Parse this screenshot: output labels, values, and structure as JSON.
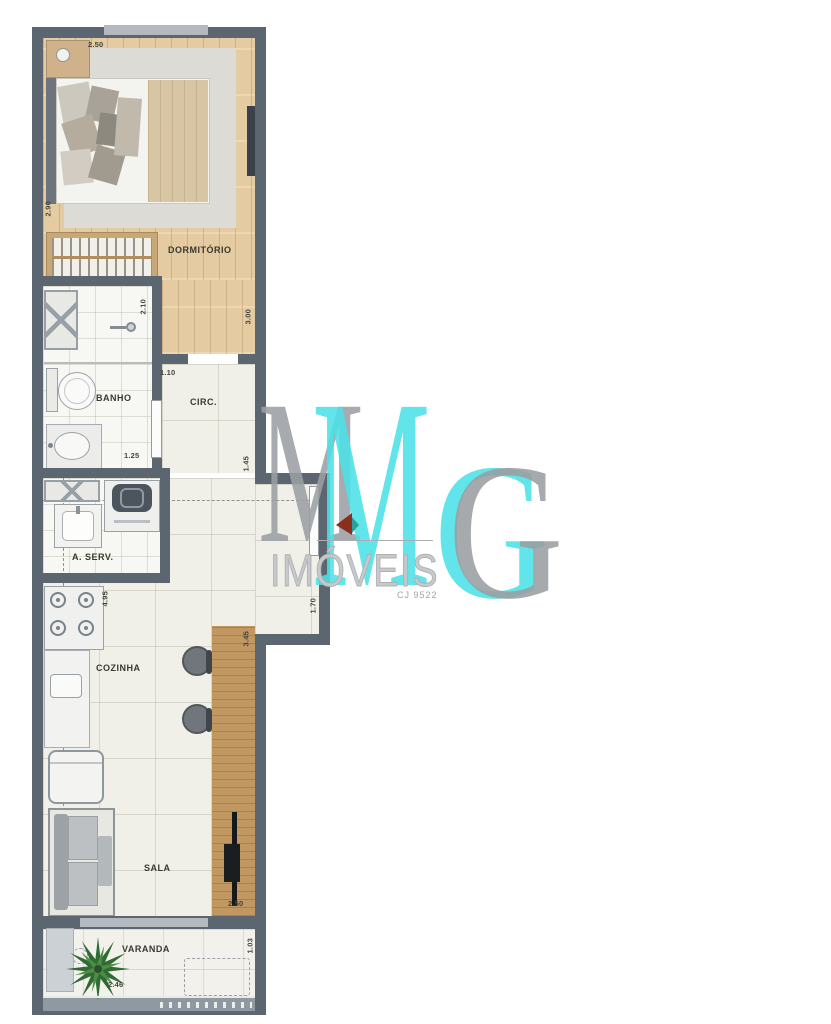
{
  "floorplan": {
    "rooms": {
      "dormitorio": {
        "label": "DORMITÓRIO"
      },
      "banho": {
        "label": "BANHO"
      },
      "circ": {
        "label": "CIRC."
      },
      "aserv": {
        "label": "A. SERV."
      },
      "cozinha": {
        "label": "COZINHA"
      },
      "sala": {
        "label": "SALA"
      },
      "varanda": {
        "label": "VARANDA"
      }
    },
    "dimensions": {
      "dorm_width_top": "2.50",
      "dorm_depth_left": "2.90",
      "dorm_depth_right": "3.00",
      "banho_depth": "2.10",
      "banho_width": "1.25",
      "circ_width": "1.10",
      "circ_depth": "1.45",
      "entry_depth": "1.70",
      "cozinha_depth": "4.95",
      "bancada_depth": "3.45",
      "sala_width": "2.50",
      "varanda_width": "2.46",
      "varanda_depth": "1.03"
    },
    "colors": {
      "wall": "#5c6670",
      "wood_floor": "#e5cba1",
      "tile_floor": "#f0efe8",
      "bar_wood": "#c19762"
    }
  },
  "watermark": {
    "letter_m": "M",
    "letter_g": "G",
    "brand": "IMÓVEIS",
    "license": "CJ 9522",
    "cyan": "#4CE2E9",
    "gray": "#9BA0A4"
  }
}
